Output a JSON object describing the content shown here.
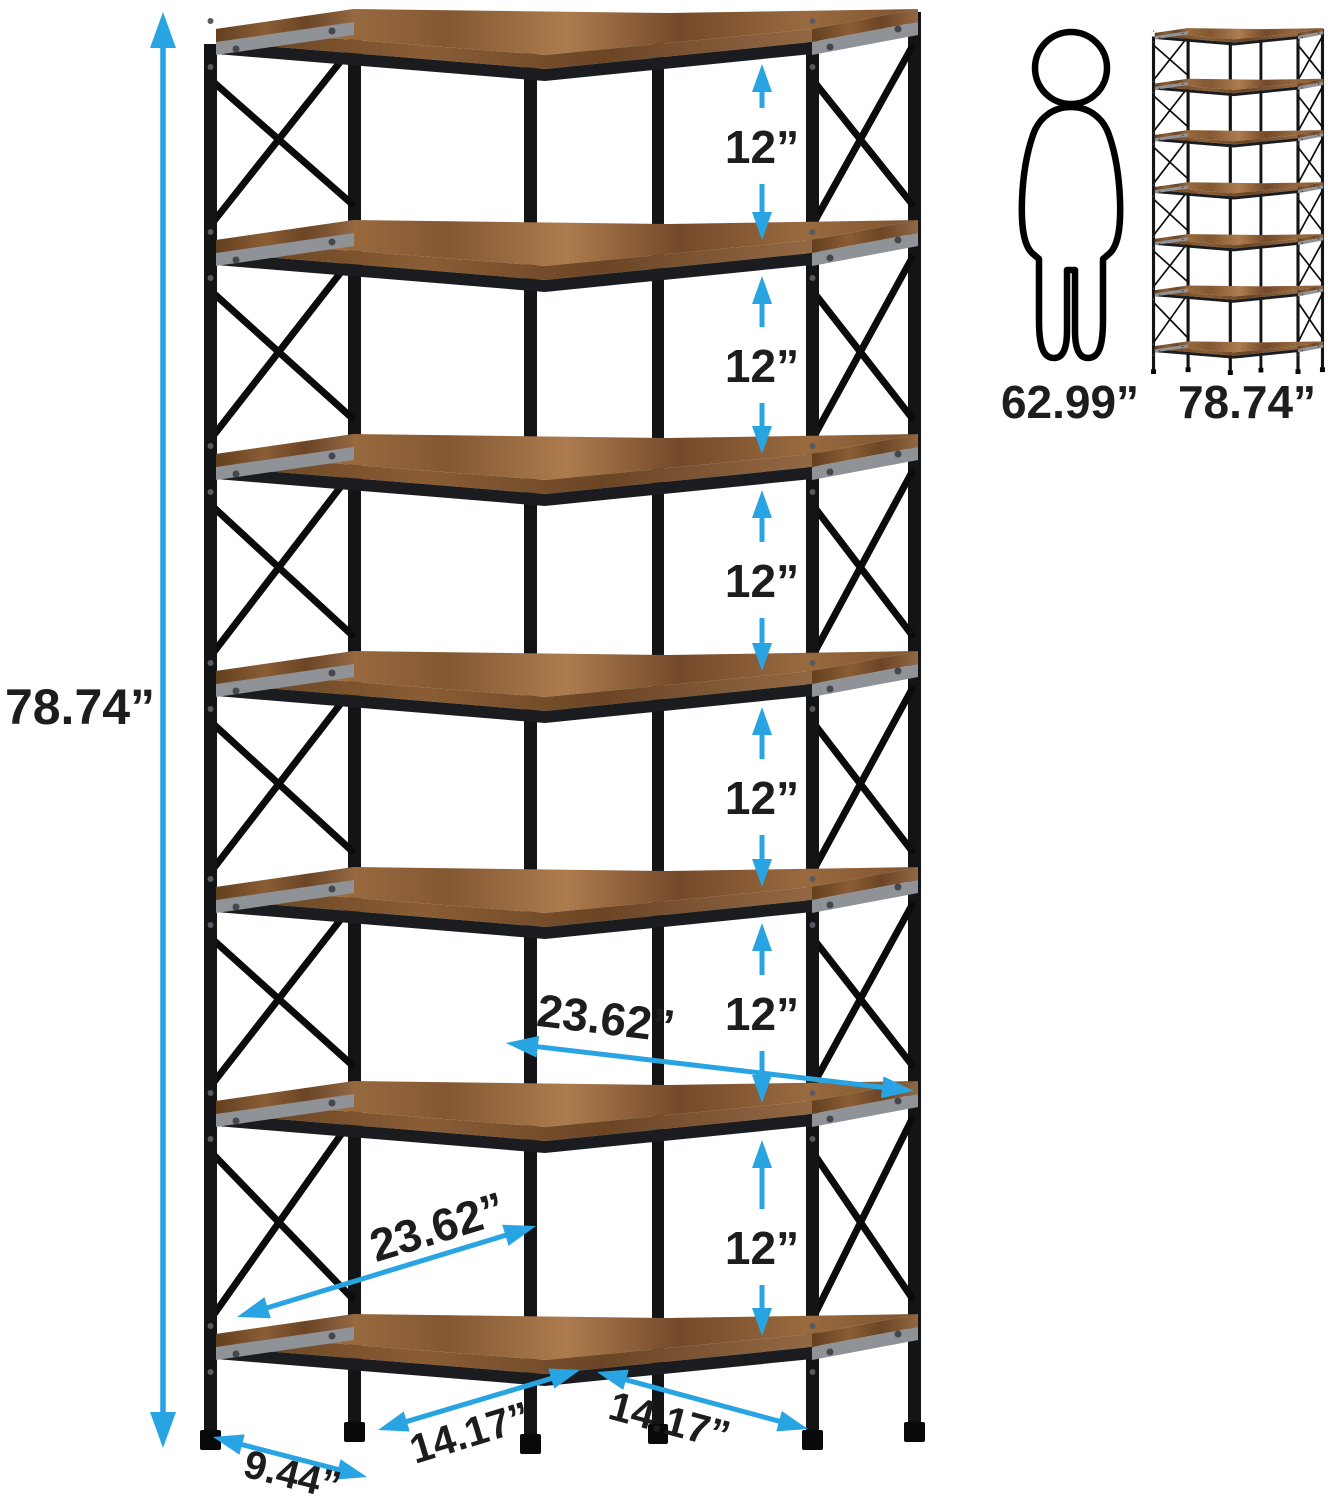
{
  "diagram": {
    "labels": {
      "total_height": "78.74”",
      "spacing": [
        "12”",
        "12”",
        "12”",
        "12”",
        "12”",
        "12”"
      ],
      "upper_wing_width": "23.62”",
      "lower_wing_width": "23.62”",
      "bottom_left_width": "14.17”",
      "bottom_right_width": "14.17”",
      "depth": "9.44”",
      "person_height": "62.99”",
      "reference_total_height": "78.74”"
    },
    "colors": {
      "accent": "#29A4E2",
      "text": "#1D1D1D",
      "wood": "#8a5c36",
      "wood_dark": "#6b4525",
      "metal": "#131416",
      "rail_gray": "#8F9397",
      "front_rail": "#1a1c1f",
      "brace": "#0b0b0b"
    }
  }
}
